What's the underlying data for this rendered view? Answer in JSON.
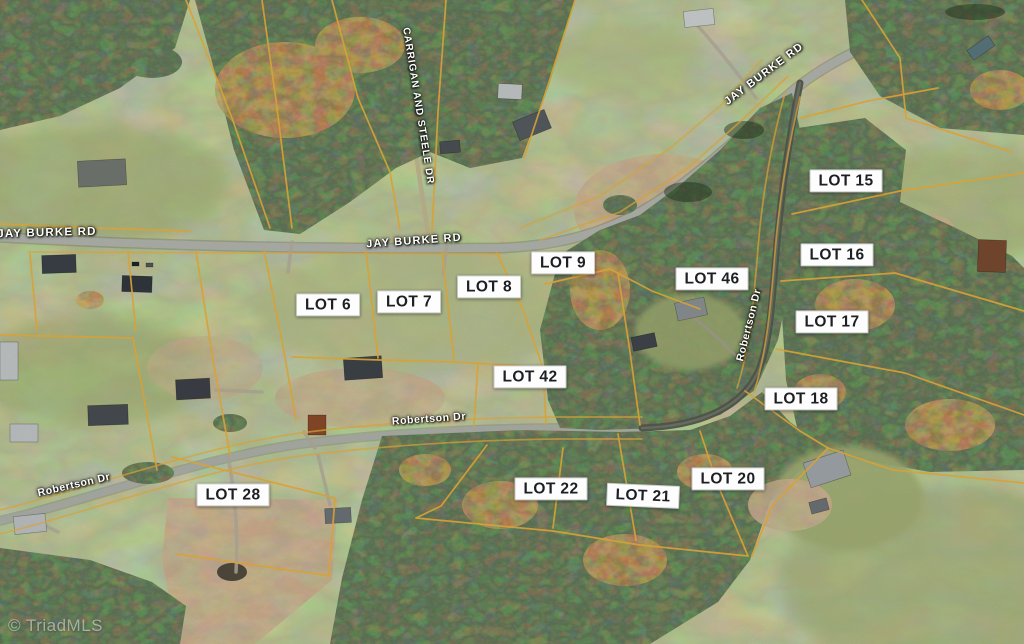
{
  "watermark": "© TriadMLS",
  "lots": [
    {
      "label": "LOT 6"
    },
    {
      "label": "LOT 7"
    },
    {
      "label": "LOT 8"
    },
    {
      "label": "LOT 9"
    },
    {
      "label": "LOT 15"
    },
    {
      "label": "LOT 16"
    },
    {
      "label": "LOT 17"
    },
    {
      "label": "LOT 18"
    },
    {
      "label": "LOT 20"
    },
    {
      "label": "LOT 21"
    },
    {
      "label": "LOT 22"
    },
    {
      "label": "LOT 28"
    },
    {
      "label": "LOT 42"
    },
    {
      "label": "LOT 46"
    }
  ],
  "roads": {
    "jay_burke_left": "JAY BURKE RD",
    "jay_burke_mid": "JAY BURKE RD",
    "jay_burke_right": "JAY BURKE RD",
    "carrigan": "CARRIGAN AND STEELE DR",
    "robertson_left": "Robertson Dr",
    "robertson_mid": "Robertson Dr",
    "robertson_vert": "Robertson Dr"
  },
  "colors": {
    "boundary_line": "#f1b53f",
    "label_background": "#fdfdfd",
    "label_text": "#1d1f24",
    "road": "#b6bab2"
  }
}
